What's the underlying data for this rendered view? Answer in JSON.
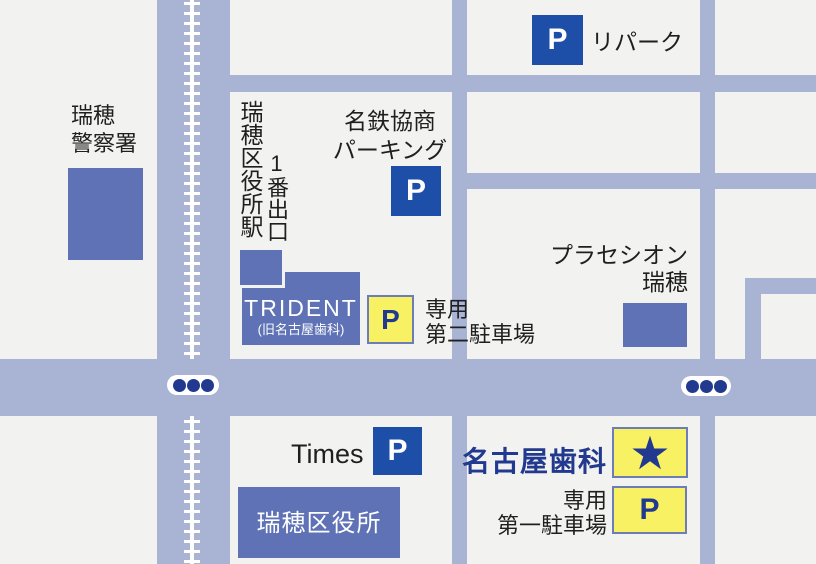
{
  "colors": {
    "background": "#f2f2f1",
    "road": "#a9b4d5",
    "building": "#5e72b5",
    "parking_blue": "#1e4fa8",
    "highlight_yellow": "#f8f163",
    "highlight_border": "#6d7eb6",
    "navy": "#21398f",
    "text_dark": "#1f1f1f"
  },
  "icons": {
    "p_label": "P",
    "star_glyph": "★"
  },
  "landmarks": {
    "police": {
      "line1": "瑞穂",
      "line2": "警察署"
    },
    "station": {
      "name": "瑞穂区役所駅",
      "exit": "1番出口"
    },
    "meitetsu_parking": {
      "line1": "名鉄協商",
      "line2": "パーキング"
    },
    "repark": {
      "name": "リパーク"
    },
    "placecion": {
      "line1": "プラセシオン",
      "line2": "瑞穂"
    },
    "trident": {
      "name": "TRIDENT",
      "subname": "(旧名古屋歯科)"
    },
    "lot2": {
      "line1": "専用",
      "line2": "第二駐車場"
    },
    "times": {
      "name": "Times"
    },
    "ward_office": {
      "name": "瑞穂区役所"
    },
    "clinic": {
      "name": "名古屋歯科"
    },
    "lot1": {
      "line1": "専用",
      "line2": "第一駐車場"
    }
  }
}
